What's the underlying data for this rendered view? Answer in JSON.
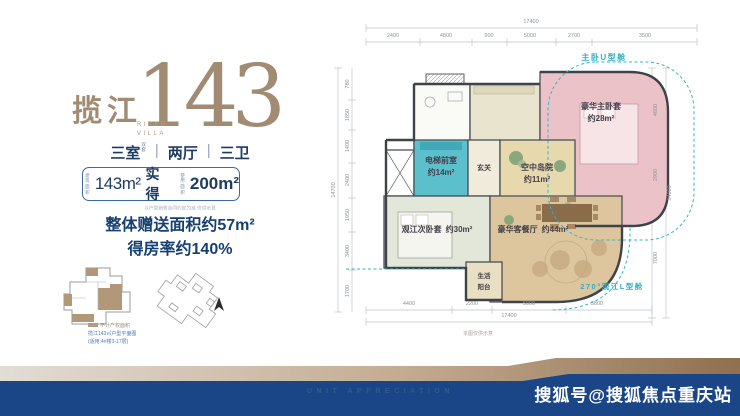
{
  "brand": {
    "title_cn": "揽江",
    "title_num": "143",
    "title_sub1": "RIVER",
    "title_sub2": "VILLA"
  },
  "specs": {
    "rooms": "三室",
    "rooms_note_line1": "双",
    "rooms_note_line2": "套",
    "sep": "|",
    "halls": "两厅",
    "baths": "三卫"
  },
  "area_pill": {
    "badge1_line1": "建筑",
    "badge1_line2": "面积",
    "value1": "143m²",
    "mid_label": "实得",
    "badge2_line1": "使用",
    "badge2_line2": "面积",
    "value2": "200m²",
    "disclaimer": "以户型销售合同约定为准 仅供示意"
  },
  "highlights": {
    "line1": "整体赠送面积约57m²",
    "line2": "得房率约140%"
  },
  "legend": {
    "swatch_label": "不计产权面积",
    "caption1": "揽江143㎡户型平面图",
    "caption2": "(适用:4#楼3-17层)"
  },
  "plan": {
    "callout_top": "主卧U型舱",
    "callout_bottom": "270°观江L型舱",
    "rooms": {
      "master": {
        "name": "豪华主卧套",
        "area": "约28m²"
      },
      "elevator_hall": {
        "name": "电梯前室",
        "area": "约14m²"
      },
      "foyer": "玄关",
      "courtyard": {
        "name": "空中岛院",
        "area": "约11m²"
      },
      "second_suite": {
        "name": "观江次卧套",
        "area": "约30m²"
      },
      "living_dining": {
        "name": "豪华客餐厅",
        "area": "约44m²"
      },
      "balcony_line1": "生活",
      "balcony_line2": "阳台"
    },
    "dims_top": {
      "total": "17400",
      "segments": [
        "2400",
        "4800",
        "900",
        "5000",
        "2700",
        "3500"
      ]
    },
    "dims_left": {
      "total": "14700",
      "segments": [
        "780",
        "1850",
        "1400",
        "2400",
        "1950",
        "3400",
        "1700"
      ]
    },
    "dims_right": {
      "total": "14000",
      "segments": [
        "4800",
        "2900",
        "7000"
      ]
    },
    "dims_bottom": {
      "total": "17400",
      "segments": [
        "4400",
        "2200",
        "5000",
        "3800"
      ]
    },
    "note": "本图仅供示意"
  },
  "footer": {
    "tagline": "UNIT APPRECIATION",
    "watermark": "搜狐号@搜狐焦点重庆站"
  },
  "icons": {
    "compass": "north-arrow"
  },
  "accents": {
    "brand_bronze": "#a28b73",
    "navy": "#16406f",
    "teal_room": "#5cc0cc",
    "pink_room": "#ecc2c9",
    "tan_room": "#ddc69e",
    "callout_cyan": "#35b4c8",
    "footer_blue": "#1a4687"
  }
}
